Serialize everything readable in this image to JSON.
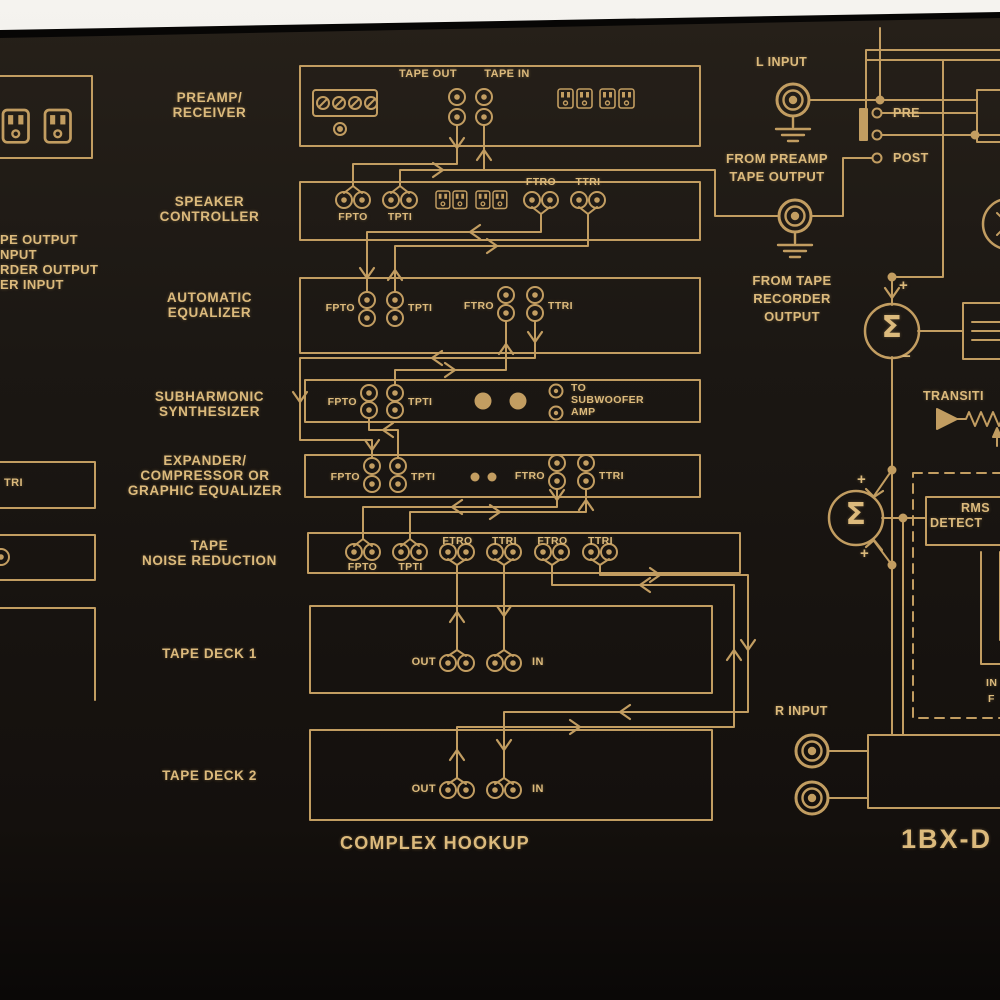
{
  "colors": {
    "gold": "#c9a365",
    "gold_text": "#dcba7c",
    "panel": "#1a1612",
    "background": "#ece9e4"
  },
  "left_edge": {
    "truncated_text_lines": [
      "PE OUTPUT",
      "NPUT",
      "RDER OUTPUT",
      "ER INPUT"
    ],
    "truncated_jack_label": "TRI"
  },
  "component_labels": [
    {
      "lines": [
        "PREAMP/",
        "RECEIVER"
      ]
    },
    {
      "lines": [
        "SPEAKER",
        "CONTROLLER"
      ]
    },
    {
      "lines": [
        "AUTOMATIC",
        "EQUALIZER"
      ]
    },
    {
      "lines": [
        "SUBHARMONIC",
        "SYNTHESIZER"
      ]
    },
    {
      "lines": [
        "EXPANDER/",
        "COMPRESSOR OR",
        "GRAPHIC EQUALIZER"
      ]
    },
    {
      "lines": [
        "TAPE",
        "NOISE REDUCTION"
      ]
    },
    {
      "lines": [
        "TAPE DECK  1"
      ]
    },
    {
      "lines": [
        "TAPE DECK  2"
      ]
    }
  ],
  "preamp_box": {
    "tape_out": "TAPE OUT",
    "tape_in": "TAPE IN"
  },
  "speaker_box": {
    "fpto": "FPTO",
    "tpti": "TPTI",
    "ftro": "FTRO",
    "ttri": "TTRI"
  },
  "auto_eq_box": {
    "fpto": "FPTO",
    "tpti": "TPTI",
    "ftro": "FTRO",
    "ttri": "TTRI"
  },
  "subharmonic_box": {
    "fpto": "FPTO",
    "tpti": "TPTI",
    "note_lines": [
      "TO",
      "SUBWOOFER",
      "AMP"
    ]
  },
  "expander_box": {
    "fpto": "FPTO",
    "tpti": "TPTI",
    "ftro": "FTRO",
    "ttri": "TTRI"
  },
  "noise_reduction_box": {
    "fpto": "FPTO",
    "tpti": "TPTI",
    "ftro1": "FTRO",
    "ttri1": "TTRI",
    "ftro2": "FTRO",
    "ttri2": "TTRI"
  },
  "tape_deck1_box": {
    "out": "OUT",
    "in": "IN"
  },
  "tape_deck2_box": {
    "out": "OUT",
    "in": "IN"
  },
  "caption": "COMPLEX HOOKUP",
  "right_diagram": {
    "l_input": "L INPUT",
    "r_input": "R INPUT",
    "from_preamp_lines": [
      "FROM PREAMP",
      "TAPE OUTPUT"
    ],
    "from_tape_lines": [
      "FROM TAPE",
      "RECORDER",
      "OUTPUT"
    ],
    "pre": "PRE",
    "post": "POST",
    "sigma": "Σ",
    "plus": "+",
    "minus": "−",
    "transition_truncated": "TRANSITI",
    "rms_lines": [
      "RMS",
      "DETECT"
    ],
    "partial_lines": [
      "IN",
      "F"
    ],
    "model_truncated": "1BX-D"
  }
}
